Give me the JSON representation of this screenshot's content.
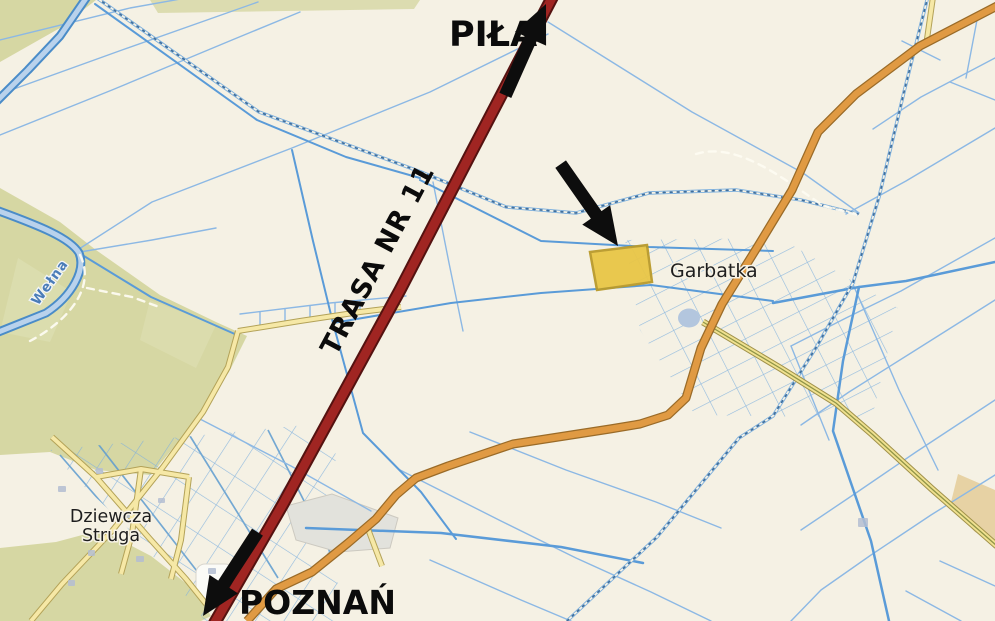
{
  "map": {
    "type": "street-map-with-annotations",
    "background_color": "#f5f1e4",
    "place_labels": {
      "garbatka": "Garbatka",
      "dziewcza_line1": "Dziewcza",
      "dziewcza_line2": "Struga",
      "welna_river": "Wełna"
    },
    "annotations": {
      "destination_north": "PIŁA",
      "destination_south": "POZNAŃ",
      "road_label": "TRASA NR 11",
      "arrows": [
        {
          "name": "arrow-north-pila",
          "direction": "up",
          "points_to": "PIŁA"
        },
        {
          "name": "arrow-parcel-pointer",
          "direction": "down-right",
          "points_to": "highlighted parcel"
        },
        {
          "name": "arrow-south-poznan",
          "direction": "down",
          "points_to": "POZNAŃ"
        }
      ]
    },
    "colors": {
      "trunk_road_fill": "#a02522",
      "trunk_road_casing": "#551210",
      "secondary_road_fill": "#e09a43",
      "secondary_road_casing": "#9a6b28",
      "minor_road_fill": "#f6e8a6",
      "minor_road_casing": "#b3a258",
      "waterway": "#5a9bd8",
      "river_core": "#b9d2ec",
      "heath_green": "#d6d7a3",
      "highlight_parcel_fill": "#e9c647",
      "highlight_parcel_border": "#b99a2b",
      "annotation_black": "#0d0d0d",
      "background": "#f5f1e4"
    }
  }
}
